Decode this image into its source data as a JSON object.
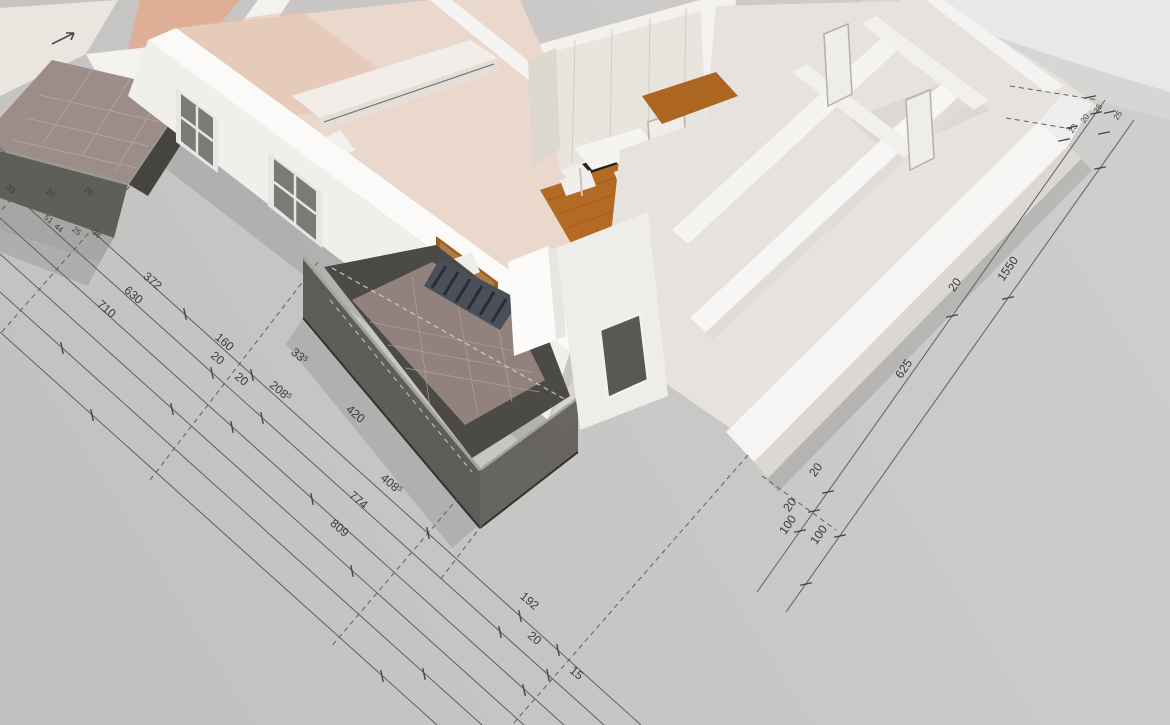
{
  "scene": {
    "title": "3D architectural floor plan perspective render with dimension annotations",
    "background": "#c8c7c6",
    "description": "White 3D apartment model viewed from above at an angle; wooden floors, kitchen, balconies with dark glass railings; chained dimension lines with tick marks drawn on the gray ground plane"
  },
  "colors": {
    "ground": "#c8c7c6",
    "backdrop_light": "#e9e8e6",
    "wall_bright": "#f5f4f2",
    "wall_shadow": "#dcdad6",
    "wall_cream": "#e9e5df",
    "floor_pink": "#e9d8cb",
    "floor_salmon": "#dfae97",
    "floor_wood": "#b06828",
    "tile_mauve": "#92827e",
    "glass_dark": "#514f4a",
    "dim_line": "#5f5f5d",
    "dim_text": "#3a3a3a"
  },
  "dimension_labels": {
    "left_main_rotation": 40,
    "right_main_rotation": -55,
    "left_main": [
      {
        "t": "372",
        "x": 150,
        "y": 284
      },
      {
        "t": "630",
        "x": 131,
        "y": 298
      },
      {
        "t": "710",
        "x": 104,
        "y": 312
      },
      {
        "t": "160",
        "x": 222,
        "y": 345
      },
      {
        "t": "20",
        "x": 215,
        "y": 361
      },
      {
        "t": "20",
        "x": 239,
        "y": 382
      },
      {
        "t": "208",
        "x": 278,
        "y": 394,
        "sup": "5"
      },
      {
        "t": "33",
        "x": 297,
        "y": 359,
        "sup": "5"
      },
      {
        "t": "420",
        "x": 353,
        "y": 417
      },
      {
        "t": "408",
        "x": 389,
        "y": 487,
        "sup": "5"
      },
      {
        "t": "774",
        "x": 356,
        "y": 503
      },
      {
        "t": "809",
        "x": 337,
        "y": 531
      },
      {
        "t": "192",
        "x": 527,
        "y": 604
      },
      {
        "t": "20",
        "x": 532,
        "y": 641
      },
      {
        "t": "15",
        "x": 574,
        "y": 676
      }
    ],
    "left_small": [
      {
        "t": "33",
        "x": 9,
        "y": 191
      },
      {
        "t": "20",
        "x": 49,
        "y": 195
      },
      {
        "t": "26",
        "x": 87,
        "y": 193
      },
      {
        "t": "51",
        "x": 47,
        "y": 221
      },
      {
        "t": "44",
        "x": 57,
        "y": 230
      },
      {
        "t": "25",
        "x": 75,
        "y": 233
      },
      {
        "t": "36",
        "x": 95,
        "y": 236
      }
    ],
    "right_main": [
      {
        "t": "625",
        "x": 907,
        "y": 371
      },
      {
        "t": "20",
        "x": 958,
        "y": 287
      },
      {
        "t": "1550",
        "x": 1011,
        "y": 271
      },
      {
        "t": "100",
        "x": 791,
        "y": 527
      },
      {
        "t": "100",
        "x": 822,
        "y": 537
      },
      {
        "t": "20",
        "x": 819,
        "y": 472
      },
      {
        "t": "20",
        "x": 793,
        "y": 507
      }
    ],
    "right_small": [
      {
        "t": "25",
        "x": 1100,
        "y": 110
      },
      {
        "t": "20",
        "x": 1087,
        "y": 120
      },
      {
        "t": "23",
        "x": 1075,
        "y": 130
      },
      {
        "t": "25",
        "x": 1120,
        "y": 117
      }
    ]
  },
  "dimension_geometry": {
    "left_lines": [
      {
        "x1": 0,
        "y1": 148,
        "x2": 641,
        "y2": 725
      },
      {
        "x1": 0,
        "y1": 182,
        "x2": 604,
        "y2": 725
      },
      {
        "x1": 0,
        "y1": 218,
        "x2": 564,
        "y2": 725
      },
      {
        "x1": 0,
        "y1": 254,
        "x2": 524,
        "y2": 725
      },
      {
        "x1": 0,
        "y1": 292,
        "x2": 482,
        "y2": 725
      },
      {
        "x1": 0,
        "y1": 332,
        "x2": 437,
        "y2": 725
      }
    ],
    "right_lines": [
      {
        "x1": 757,
        "y1": 592,
        "x2": 1105,
        "y2": 100
      },
      {
        "x1": 786,
        "y1": 612,
        "x2": 1134,
        "y2": 120
      }
    ],
    "left_ticks": [
      [
        185,
        314
      ],
      [
        252,
        375
      ],
      [
        428,
        533
      ],
      [
        520,
        616
      ],
      [
        558,
        650
      ],
      [
        212,
        373
      ],
      [
        262,
        418
      ],
      [
        500,
        632
      ],
      [
        548,
        675
      ],
      [
        232,
        427
      ],
      [
        312,
        499
      ],
      [
        524,
        690
      ],
      [
        172,
        409
      ],
      [
        352,
        571
      ],
      [
        62,
        348
      ],
      [
        424,
        674
      ],
      [
        92,
        415
      ],
      [
        382,
        676
      ]
    ],
    "right_ticks": [
      [
        800,
        531
      ],
      [
        814,
        511
      ],
      [
        828,
        492
      ],
      [
        952,
        316
      ],
      [
        1096,
        113
      ],
      [
        806,
        584
      ],
      [
        840,
        536
      ],
      [
        1008,
        298
      ],
      [
        1100,
        168
      ],
      [
        1090,
        97
      ],
      [
        1104,
        133
      ],
      [
        1072,
        127
      ],
      [
        1110,
        112
      ],
      [
        1064,
        140
      ]
    ],
    "dashed_extensions": [
      {
        "x1": 318,
        "y1": 262,
        "x2": 150,
        "y2": 480
      },
      {
        "x1": 482,
        "y1": 470,
        "x2": 330,
        "y2": 648
      },
      {
        "x1": 575,
        "y1": 403,
        "x2": 440,
        "y2": 580
      },
      {
        "x1": 748,
        "y1": 455,
        "x2": 512,
        "y2": 725
      },
      {
        "x1": 130,
        "y1": 186,
        "x2": 0,
        "y2": 334
      },
      {
        "x1": 35,
        "y1": 172,
        "x2": 0,
        "y2": 212
      },
      {
        "x1": 762,
        "y1": 476,
        "x2": 836,
        "y2": 530
      },
      {
        "x1": 1010,
        "y1": 86,
        "x2": 1098,
        "y2": 100
      },
      {
        "x1": 1006,
        "y1": 118,
        "x2": 1072,
        "y2": 129
      }
    ]
  }
}
